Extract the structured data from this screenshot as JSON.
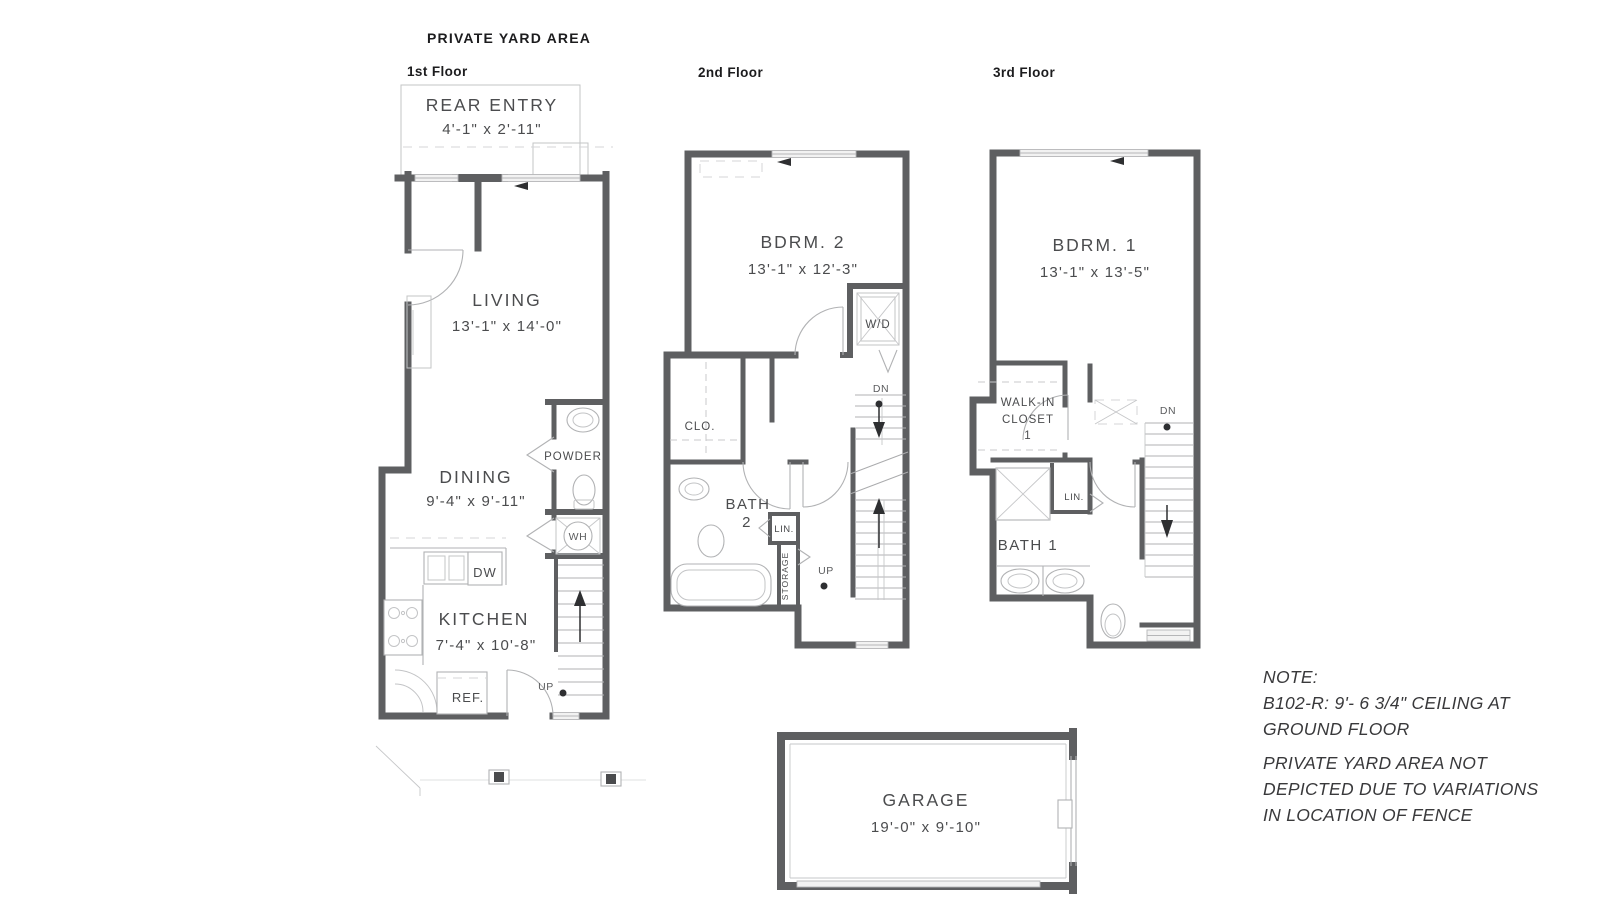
{
  "title": "PRIVATE YARD AREA",
  "floor1": {
    "label": "1st Floor",
    "rear_entry": {
      "name": "REAR ENTRY",
      "dims": "4'-1\" x 2'-11\""
    },
    "living": {
      "name": "LIVING",
      "dims": "13'-1\" x 14'-0\""
    },
    "dining": {
      "name": "DINING",
      "dims": "9'-4\" x 9'-11\""
    },
    "kitchen": {
      "name": "KITCHEN",
      "dims": "7'-4\" x 10'-8\""
    },
    "powder_label": "POWDER",
    "wh_label": "WH",
    "dw_label": "DW",
    "ref_label": "REF.",
    "up_label": "UP"
  },
  "floor2": {
    "label": "2nd Floor",
    "bedroom": {
      "name": "BDRM. 2",
      "dims": "13'-1\" x 12'-3\""
    },
    "wd_label": "W/D",
    "clo_label": "CLO.",
    "bath_name": "BATH",
    "bath_number": "2",
    "lin_label": "LIN.",
    "storage_label": "STORAGE",
    "dn_label": "DN",
    "up_label": "UP"
  },
  "floor3": {
    "label": "3rd Floor",
    "bedroom": {
      "name": "BDRM. 1",
      "dims": "13'-1\" x 13'-5\""
    },
    "walkin": {
      "line1": "WALK-IN",
      "line2": "CLOSET",
      "line3": "1"
    },
    "lin_label": "LIN.",
    "bath_label": "BATH 1",
    "dn_label": "DN"
  },
  "garage": {
    "name": "GARAGE",
    "dims": "19'-0\" x 9'-10\""
  },
  "note": {
    "heading": "NOTE:",
    "lines": [
      "B102-R: 9'- 6 3/4\" CEILING AT",
      "GROUND FLOOR",
      "PRIVATE YARD AREA NOT",
      "DEPICTED DUE TO VARIATIONS",
      "IN LOCATION OF FENCE"
    ]
  },
  "colors": {
    "wall": "#5e5f61",
    "line_light": "#b1b2b4",
    "text": "#4b4c4e",
    "heading_text": "#1c1c1e",
    "note_text": "#39393b"
  }
}
